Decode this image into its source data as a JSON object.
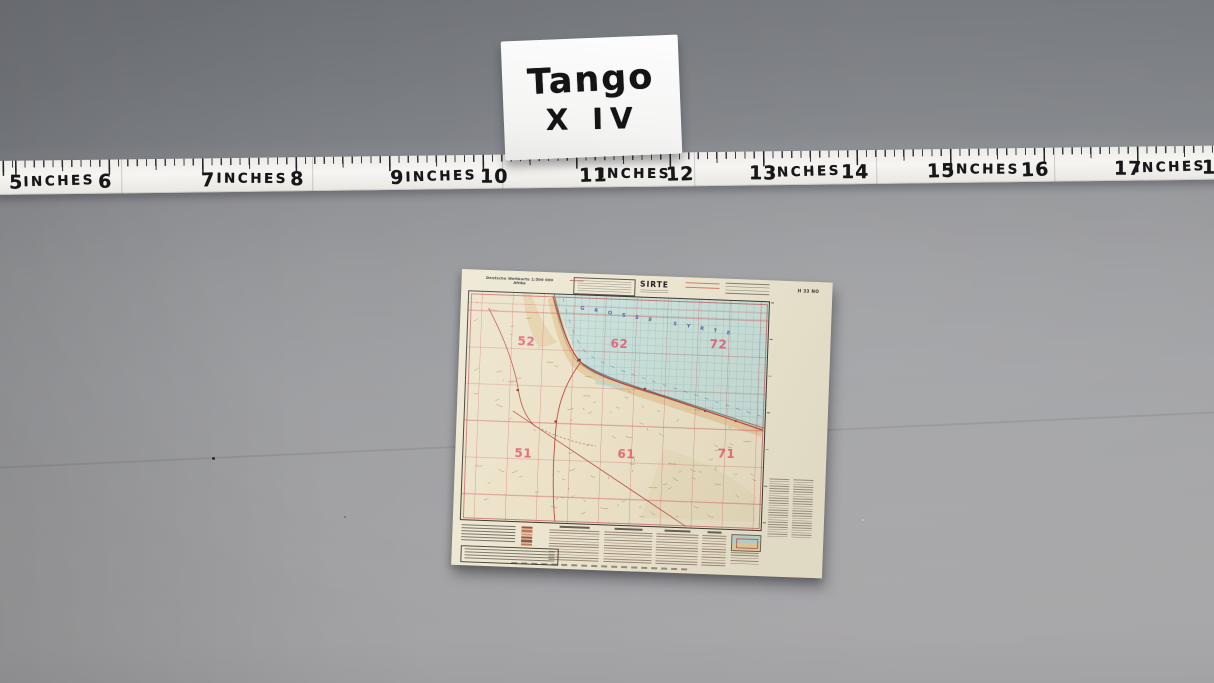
{
  "label_card": {
    "line1": "Tango",
    "line2": "X IV"
  },
  "ruler": {
    "unit_word": "INCHES",
    "labels": [
      {
        "t": "5",
        "x": 22
      },
      {
        "t": "INCHES",
        "x": 65,
        "s": 1
      },
      {
        "t": "6",
        "x": 111
      },
      {
        "t": "7",
        "x": 214
      },
      {
        "t": "INCHES",
        "x": 258,
        "s": 1
      },
      {
        "t": "8",
        "x": 303
      },
      {
        "t": "9",
        "x": 403
      },
      {
        "t": "INCHES",
        "x": 447,
        "s": 1
      },
      {
        "t": "10",
        "x": 500
      },
      {
        "t": "11",
        "x": 599
      },
      {
        "t": "INCHES",
        "x": 641,
        "s": 1
      },
      {
        "t": "12",
        "x": 686
      },
      {
        "t": "13",
        "x": 769
      },
      {
        "t": "INCHES",
        "x": 811,
        "s": 1
      },
      {
        "t": "14",
        "x": 861
      },
      {
        "t": "15",
        "x": 947
      },
      {
        "t": "INCHES",
        "x": 990,
        "s": 1
      },
      {
        "t": "16",
        "x": 1041
      },
      {
        "t": "17",
        "x": 1134
      },
      {
        "t": "INCHES",
        "x": 1176,
        "s": 1
      },
      {
        "t": "18",
        "x": 1222
      }
    ],
    "seams": [
      127,
      318,
      508,
      700,
      882,
      1060
    ]
  },
  "map_sheet": {
    "title": "SIRTE",
    "series_line1": "Deutsche Weltkarte 1:500 000",
    "series_line2": "Afrika",
    "sheet_code": "H 33 NO",
    "sea_label": "GROSSE SYRTE",
    "zone_numbers": [
      {
        "t": "52",
        "x": 59,
        "y": 48
      },
      {
        "t": "62",
        "x": 152,
        "y": 47
      },
      {
        "t": "72",
        "x": 251,
        "y": 44
      },
      {
        "t": "51",
        "x": 60,
        "y": 160
      },
      {
        "t": "61",
        "x": 163,
        "y": 157
      },
      {
        "t": "71",
        "x": 263,
        "y": 153
      }
    ],
    "colors": {
      "paper": "#ece6d1",
      "sea": "#c7ded7",
      "land": "#ebe2c8",
      "grid_red": "#d05868",
      "zone_red": "#e4506b",
      "road_red": "#b5372b",
      "sea_text_blue": "#33539c"
    }
  }
}
